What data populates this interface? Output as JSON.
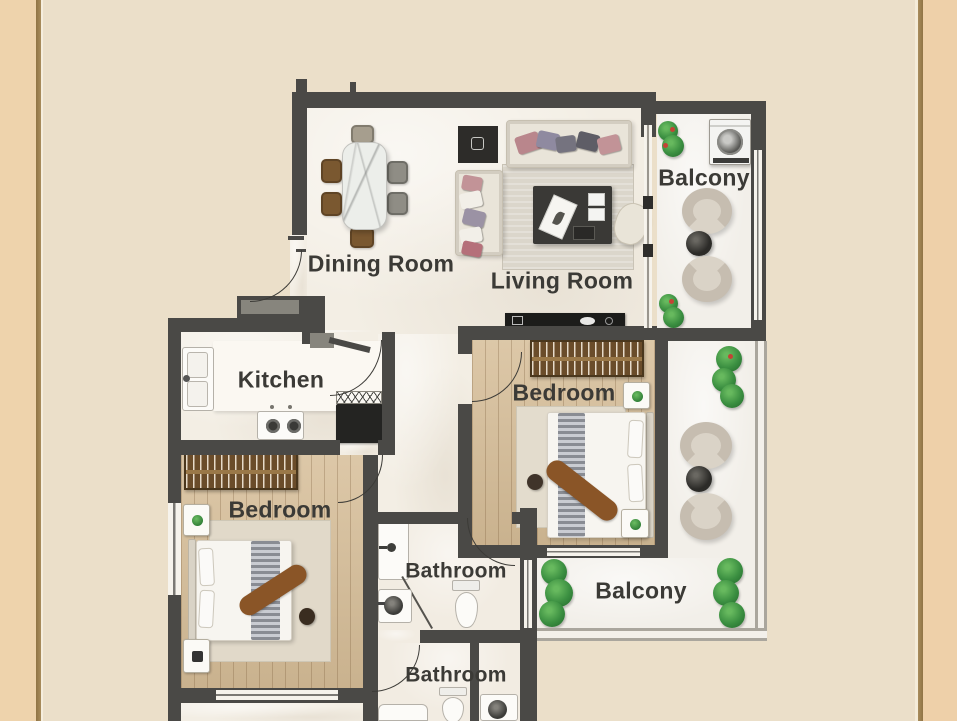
{
  "page": {
    "type": "apartment-floor-plan"
  },
  "colors": {
    "canvas_background": "#ebdfc9",
    "side_border_panel": "#eed2ab",
    "side_border_line": "#a28455",
    "wall": "#4a4946",
    "label_text": "#3b3a36",
    "interior_floor": "#f3eee4",
    "wood_floor": "#d6bd97",
    "balcony_floor": "#f2efe9",
    "plant_green": "#3b8f41",
    "throw_brown": "#8a5527"
  },
  "rooms": {
    "dining_room": {
      "label": "Dining Room"
    },
    "living_room": {
      "label": "Living Room"
    },
    "kitchen": {
      "label": "Kitchen"
    },
    "bedroom_upper": {
      "label": "Bedroom"
    },
    "bedroom_lower": {
      "label": "Bedroom"
    },
    "bathroom_upper": {
      "label": "Bathroom"
    },
    "bathroom_lower": {
      "label": "Bathroom"
    },
    "balcony_upper": {
      "label": "Balcony"
    },
    "balcony_lower": {
      "label": "Balcony"
    }
  },
  "furniture_inventory": {
    "dining_room": [
      "marble-dining-table",
      "six-dining-chairs"
    ],
    "living_room": [
      "three-seat-sofa",
      "two-seat-sofa",
      "coffee-table",
      "area-rug",
      "media-cabinet",
      "accent-chair"
    ],
    "kitchen": [
      "double-sink",
      "countertop",
      "cooktop",
      "dish-rack",
      "refrigerator"
    ],
    "bedroom_upper": [
      "tv-console",
      "wardrobe",
      "double-bed",
      "two-nightstands",
      "rug",
      "pouf"
    ],
    "bedroom_lower": [
      "wardrobe",
      "double-bed",
      "two-nightstands",
      "rug",
      "pouf"
    ],
    "bathroom_upper": [
      "shower",
      "washbasin",
      "toilet"
    ],
    "bathroom_lower": [
      "toilet",
      "washbasin",
      "bathtub"
    ],
    "balcony_upper": [
      "washing-machine",
      "two-armchairs",
      "round-table",
      "plants"
    ],
    "balcony_lower": [
      "two-armchairs",
      "round-table",
      "plants"
    ]
  }
}
